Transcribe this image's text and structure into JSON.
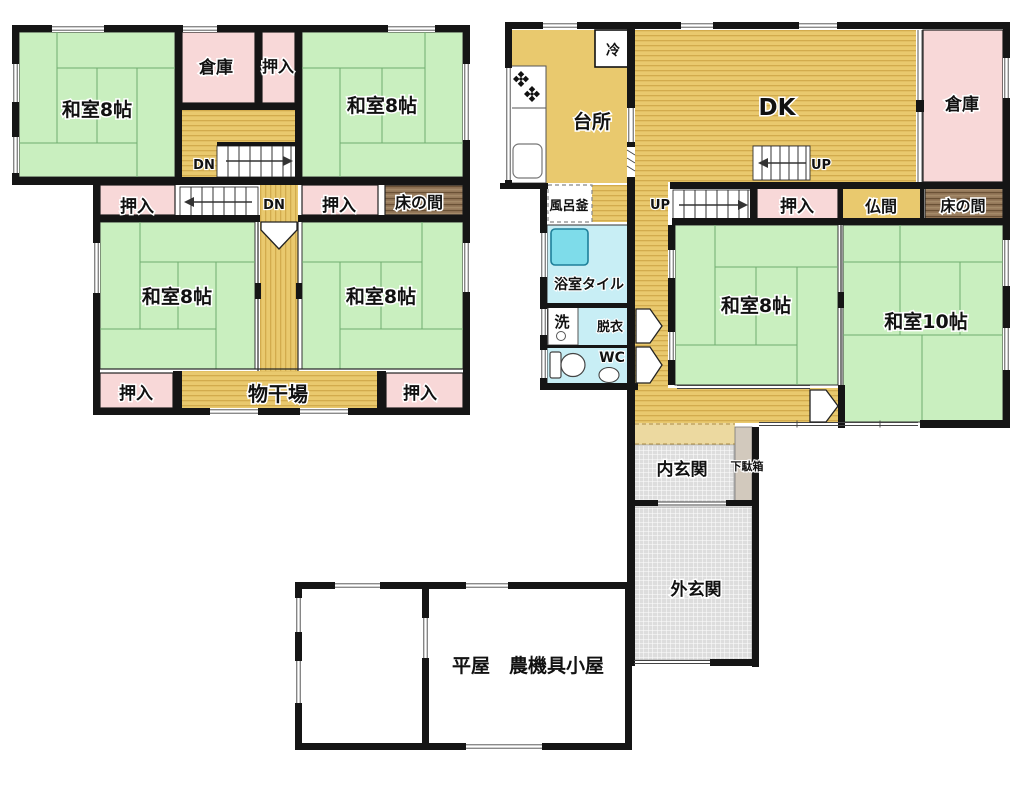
{
  "title": "間取り図",
  "colors": {
    "tatami": "#c9efbf",
    "wood": "#e9c96e",
    "wood_stripe": "#d2ab4d",
    "wood_light": "#ecd9a0",
    "closet": "#f8d8d8",
    "bath": "#c8eef5",
    "tub": "#7edcea",
    "tokonoma": "#94785a",
    "tokonoma_streak": "#6a5136",
    "entrance": "#dddddd",
    "getabako": "#d2c9bd",
    "wall": "#151515"
  },
  "labels": {
    "f2_washitsu_nw": "和室8帖",
    "f2_souko": "倉庫",
    "f2_oshiire_top": "押入",
    "f2_washitsu_ne": "和室8帖",
    "f2_dn_upper": "DN",
    "f2_oshiire_w": "押入",
    "f2_dn_lower": "DN",
    "f2_oshiire_e": "押入",
    "f2_tokonoma": "床の間",
    "f2_washitsu_sw": "和室8帖",
    "f2_washitsu_se": "和室8帖",
    "f2_oshiire_sw": "押入",
    "f2_monohoshiba": "物干場",
    "f2_oshiire_se": "押入",
    "f1_rei": "冷",
    "f1_daidokoro": "台所",
    "f1_dk": "DK",
    "f1_souko": "倉庫",
    "f1_furogama": "風呂釜",
    "f1_up_lower": "UP",
    "f1_up_upper": "UP",
    "f1_oshiire": "押入",
    "f1_butsuma": "仏間",
    "f1_tokonoma": "床の間",
    "f1_yokushitsu": "浴室タイル",
    "f1_sen": "洗",
    "f1_datsui": "脱衣",
    "f1_wc": "WC",
    "f1_washitsu8": "和室8帖",
    "f1_washitsu10": "和室10帖",
    "f1_uchi_genkan": "内玄関",
    "f1_getabako": "下駄箱",
    "f1_soto_genkan": "外玄関",
    "outbuilding": "平屋　農機具小屋"
  }
}
